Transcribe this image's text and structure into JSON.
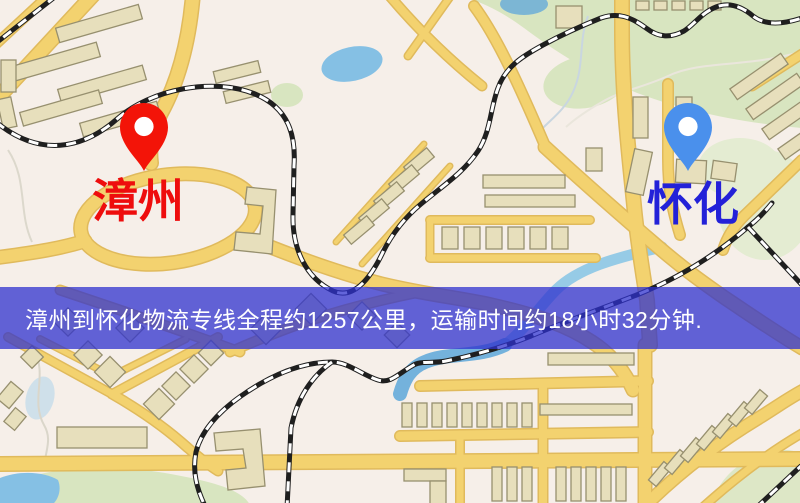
{
  "banner": {
    "text": "漳州到怀化物流专线全程约1257公里，运输时间约18小时32分钟.",
    "background_color": "#2f31cd",
    "text_color": "#ffffff"
  },
  "markers": {
    "origin": {
      "label": "漳州",
      "label_color": "#ee0d0d",
      "pin_color": "#f31408"
    },
    "destination": {
      "label": "怀化",
      "label_color": "#2321d8",
      "pin_color": "#4a90ec"
    }
  },
  "map_palette": {
    "background": "#f6efe9",
    "road_fill": "#f3d26f",
    "road_casing": "#e0ba5c",
    "building_fill": "#e7dfbc",
    "building_outline": "#97906f",
    "park": "#d8e5c0",
    "park_pale": "#e4ecd2",
    "water": "#85c0e4",
    "railway_dark": "#1f1f1f",
    "railway_light": "#ffffff"
  }
}
